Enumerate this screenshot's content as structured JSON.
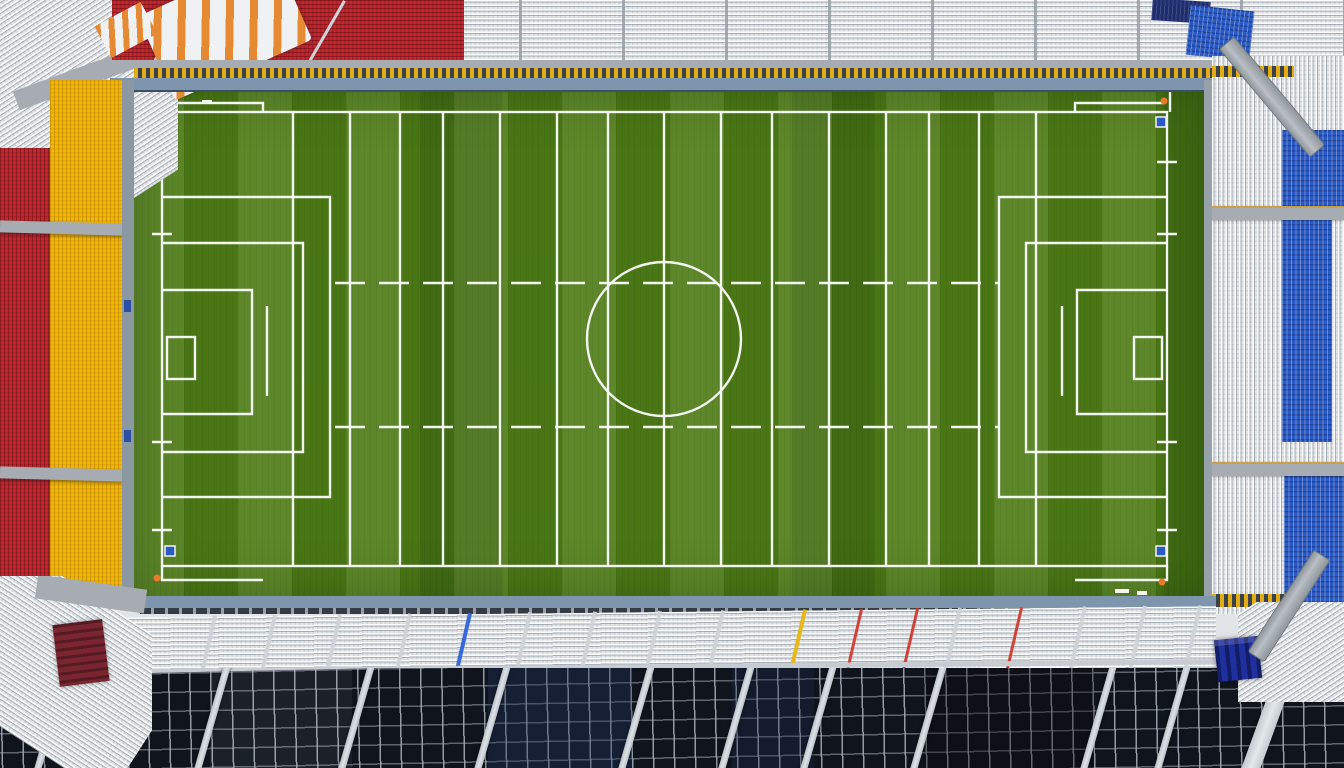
{
  "scene": {
    "type": "aerial-stadium-photograph",
    "description": "Top-down aerial photograph of an empty football stadium: a green pitch covered in white soccer and training-grid markings, surrounded by a red-and-white north stand, a red-and-yellow west stand, a blue-and-white east stand with grey access ramps, and a south stand of white seat rows above dark terraced sections crossed by silver grid walkways.",
    "pitch": {
      "label": "football-pitch",
      "markings": [
        "outer-boundary",
        "centre-line",
        "centre-circle",
        "left-penalty-area",
        "right-penalty-area",
        "nested-coaching-boxes",
        "goal-boxes",
        "vertical-training-lines",
        "dashed-hash-rows",
        "blue-corner-squares",
        "outer-corner-L-marks",
        "goal-line-ticks"
      ],
      "vertical_training_lines": 15,
      "corner_flags": 3
    },
    "stands": {
      "north": {
        "sections": [
          "white-roof-structure-with-orange-stripes",
          "red-seating-block",
          "white-seating-block",
          "navy-corner-patch",
          "blue-corner-patch"
        ],
        "front_strips": [
          "grey-walkway",
          "yellow-dashed-barrier",
          "blue-grey-walkway"
        ]
      },
      "west": {
        "sections": [
          "red-seat-column",
          "yellow-seat-column"
        ],
        "cross_aisles": 2
      },
      "east": {
        "sections": [
          "white-seat-stripes",
          "blue-seat-blocks"
        ],
        "cross_aisles": 2,
        "ramps": 2,
        "yellow_dashed_bands": 2
      },
      "south": {
        "sections": [
          "blue-grey-walkway",
          "white-seat-rows",
          "dark-terrace-grid-sections"
        ],
        "handrails": [
          "blue",
          "yellow",
          "red",
          "red",
          "red"
        ],
        "corners": [
          "white-diagonal-seats",
          "dark-red-stair-structure",
          "navy-blue-boxes"
        ]
      }
    }
  },
  "palette": {
    "grass_base": "#4f7d16",
    "line_white": "#f3f5f0",
    "seat_white": "#e2e5e8",
    "seat_red": "#c1272e",
    "seat_yellow": "#f2b606",
    "seat_blue": "#2a5ac6",
    "seat_navy": "#1e2d6e",
    "walkway_blue": "#7e95ae",
    "walkway_gray": "#a6acb1",
    "walkway_dark_edge": "#3e4e66",
    "band_dark": "#3c4249",
    "band_yellow": "#e2ac16",
    "rail_silver": "#cdd3d8",
    "terrace_dark": "#10151d",
    "terrace_grid": "#aab3bc",
    "structure_red": "#7a2530",
    "flag_orange": "#ea7a28",
    "rail_red": "#d03a2e",
    "rail_yellow": "#e8b50f",
    "rail_blue": "#2e62d9",
    "ramp_gray": "#9aa1a7",
    "aisle_tan": "#c9a14a"
  }
}
